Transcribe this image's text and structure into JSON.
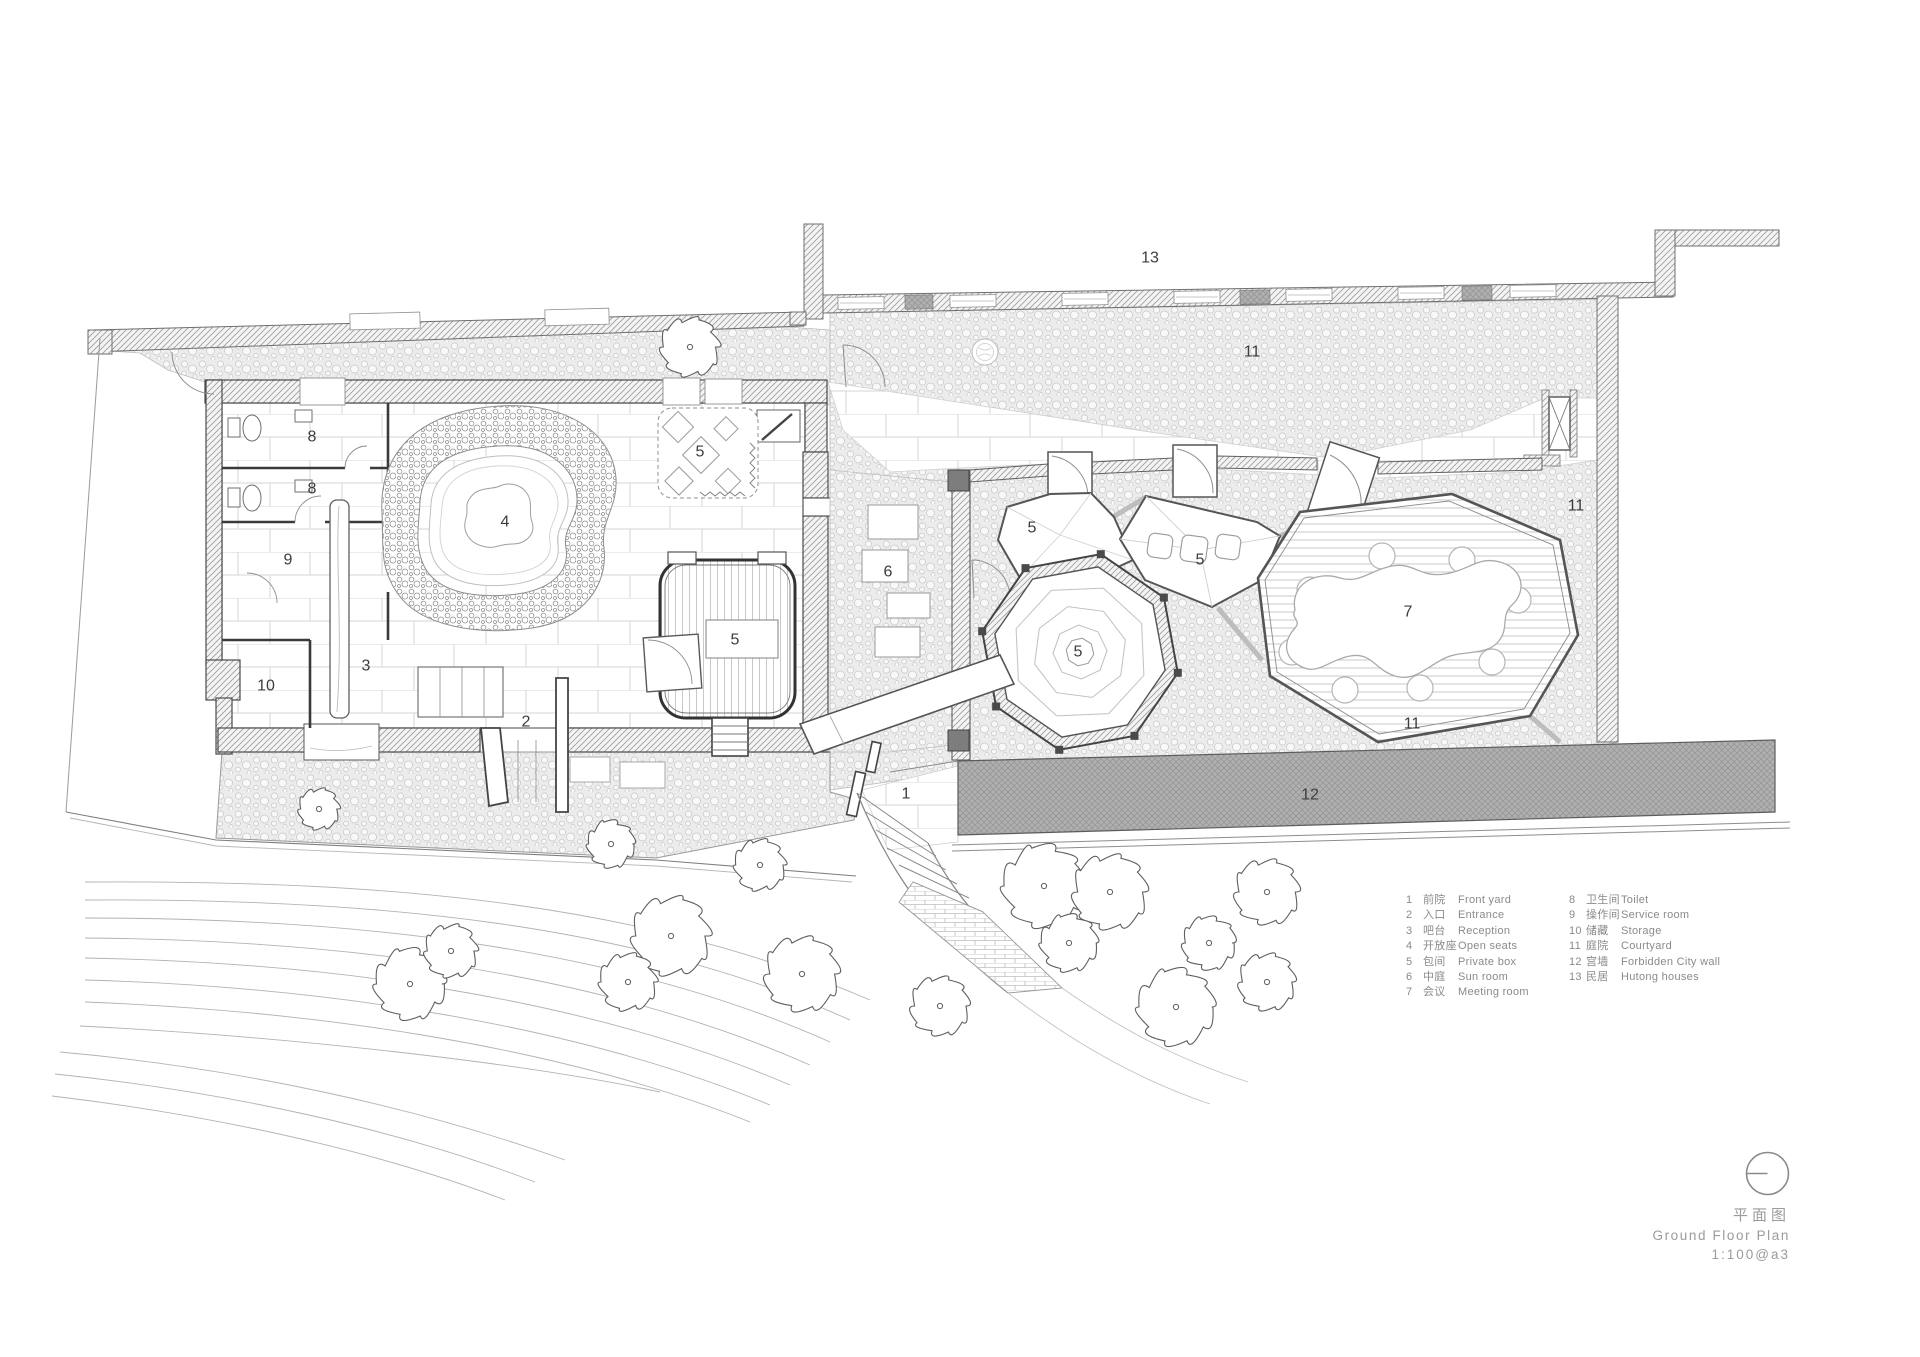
{
  "sheet": {
    "background": "#ffffff",
    "ink_color": "#3c3c3c",
    "muted_text_color": "#8a8a8a",
    "title_text_color": "#9b9b9b",
    "wall_gray": "#b0b0b0"
  },
  "plan": {
    "labels": [
      {
        "text": "13",
        "x": 1150,
        "y": 258
      },
      {
        "text": "11",
        "x": 1252,
        "y": 352
      },
      {
        "text": "11",
        "x": 1576,
        "y": 506
      },
      {
        "text": "11",
        "x": 1412,
        "y": 724
      },
      {
        "text": "12",
        "x": 1310,
        "y": 795
      },
      {
        "text": "8",
        "x": 312,
        "y": 437
      },
      {
        "text": "8",
        "x": 312,
        "y": 489
      },
      {
        "text": "9",
        "x": 288,
        "y": 560
      },
      {
        "text": "10",
        "x": 266,
        "y": 686
      },
      {
        "text": "3",
        "x": 366,
        "y": 666
      },
      {
        "text": "4",
        "x": 505,
        "y": 522
      },
      {
        "text": "5",
        "x": 700,
        "y": 452
      },
      {
        "text": "5",
        "x": 735,
        "y": 640
      },
      {
        "text": "2",
        "x": 526,
        "y": 722
      },
      {
        "text": "1",
        "x": 906,
        "y": 794
      },
      {
        "text": "6",
        "x": 888,
        "y": 572
      },
      {
        "text": "5",
        "x": 1032,
        "y": 528
      },
      {
        "text": "5",
        "x": 1200,
        "y": 560
      },
      {
        "text": "5",
        "x": 1078,
        "y": 652
      },
      {
        "text": "7",
        "x": 1408,
        "y": 612
      }
    ]
  },
  "legend": {
    "columns": [
      [
        {
          "num": "1",
          "cn": "前院",
          "en": "Front yard"
        },
        {
          "num": "2",
          "cn": "入口",
          "en": "Entrance"
        },
        {
          "num": "3",
          "cn": "吧台",
          "en": "Reception"
        },
        {
          "num": "4",
          "cn": "开放座",
          "en": "Open seats"
        },
        {
          "num": "5",
          "cn": "包间",
          "en": "Private box"
        },
        {
          "num": "6",
          "cn": "中庭",
          "en": "Sun room"
        },
        {
          "num": "7",
          "cn": "会议",
          "en": "Meeting room"
        }
      ],
      [
        {
          "num": "8",
          "cn": "卫生间",
          "en": "Toilet"
        },
        {
          "num": "9",
          "cn": "操作间",
          "en": "Service room"
        },
        {
          "num": "10",
          "cn": "储藏",
          "en": "Storage"
        },
        {
          "num": "11",
          "cn": "庭院",
          "en": "Courtyard"
        },
        {
          "num": "12",
          "cn": "宫墙",
          "en": "Forbidden City wall"
        },
        {
          "num": "13",
          "cn": "民居",
          "en": "Hutong houses"
        }
      ]
    ]
  },
  "titleblock": {
    "title_cn": "平面图",
    "title_en": "Ground Floor Plan",
    "scale": "1:100@a3"
  }
}
